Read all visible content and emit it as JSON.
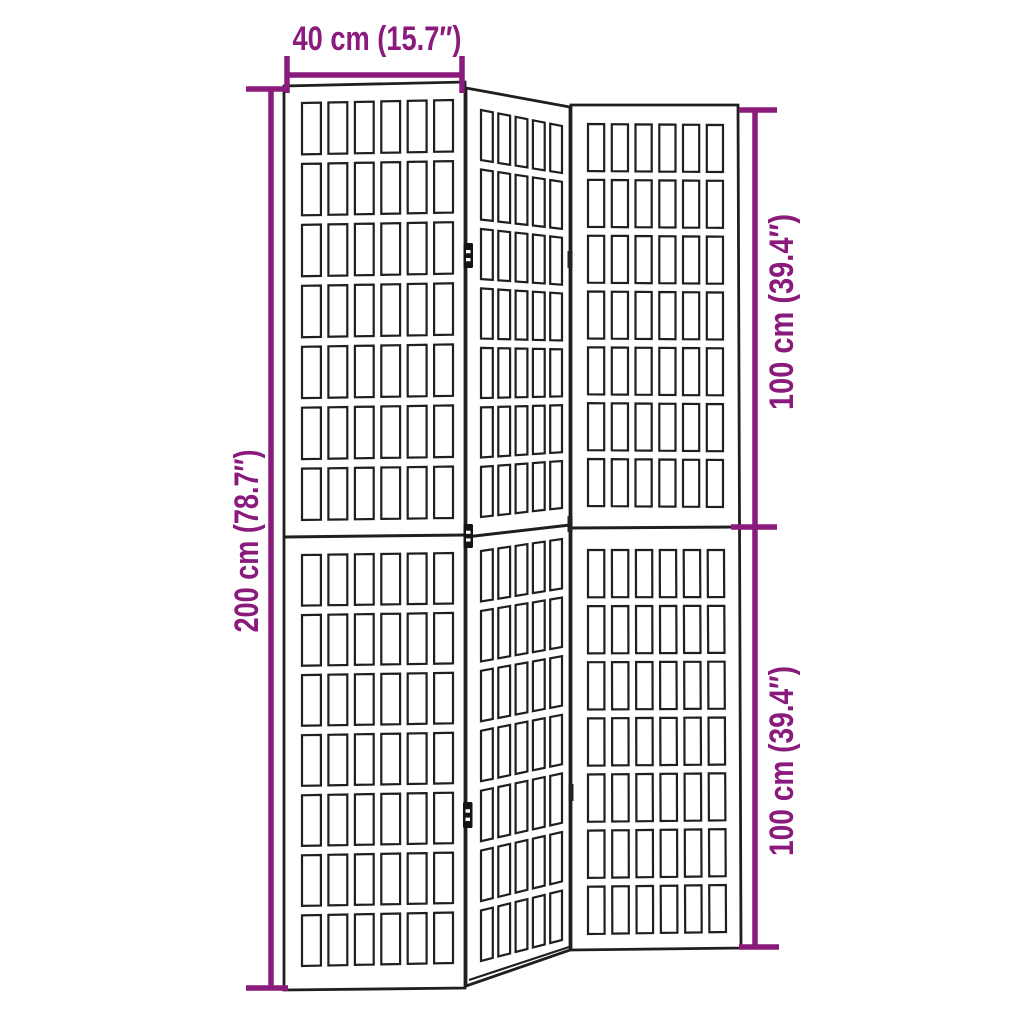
{
  "colors": {
    "dimension_annotation": "#8a1a7b",
    "figure_line": "#1f1f1f",
    "background": "#ffffff"
  },
  "dimensions": {
    "width": "40 cm (15.7″)",
    "height_total": "200 cm (78.7″)",
    "height_upper": "100 cm (39.4″)",
    "height_lower": "100 cm (39.4″)"
  },
  "figure": {
    "type": "folding-room-divider",
    "panel_count": 3,
    "line_color": "#1f1f1f",
    "panels": [
      {
        "id": "middle",
        "outer": [
          [
            466,
            88
          ],
          [
            570,
            107
          ],
          [
            570,
            950
          ],
          [
            466,
            986
          ]
        ],
        "midline": [
          466,
          537,
          570,
          525
        ],
        "halves": [
          {
            "lattice": [
              [
                481,
                110
              ],
              [
                562,
                126
              ],
              [
                562,
                508
              ],
              [
                481,
                517
              ]
            ],
            "cols": 5,
            "rows": 7,
            "gu": 0.068,
            "gv": 0.023
          },
          {
            "lattice": [
              [
                481,
                551
              ],
              [
                562,
                539
              ],
              [
                562,
                940
              ],
              [
                481,
                961
              ]
            ],
            "cols": 5,
            "rows": 7,
            "gu": 0.068,
            "gv": 0.023
          }
        ]
      },
      {
        "id": "left",
        "outer": [
          [
            284,
            86
          ],
          [
            465,
            82
          ],
          [
            465,
            988
          ],
          [
            284,
            990
          ]
        ],
        "midline": [
          284,
          537,
          465,
          535
        ],
        "halves": [
          {
            "lattice": [
              [
                302,
                103
              ],
              [
                453,
                100
              ],
              [
                453,
                518
              ],
              [
                302,
                520
              ]
            ],
            "cols": 6,
            "rows": 7,
            "gu": 0.05,
            "gv": 0.023
          },
          {
            "lattice": [
              [
                302,
                555
              ],
              [
                453,
                553
              ],
              [
                453,
                963
              ],
              [
                302,
                966
              ]
            ],
            "cols": 6,
            "rows": 7,
            "gu": 0.05,
            "gv": 0.023
          }
        ]
      },
      {
        "id": "right",
        "outer": [
          [
            571,
            105
          ],
          [
            738,
            105
          ],
          [
            741,
            948
          ],
          [
            571,
            950
          ]
        ],
        "midline": [
          571,
          528,
          739,
          527
        ],
        "halves": [
          {
            "lattice": [
              [
                588,
                124
              ],
              [
                723,
                125
              ],
              [
                723,
                507
              ],
              [
                588,
                506
              ]
            ],
            "cols": 6,
            "rows": 7,
            "gu": 0.056,
            "gv": 0.023
          },
          {
            "lattice": [
              [
                588,
                550
              ],
              [
                724,
                550
              ],
              [
                726,
                932
              ],
              [
                588,
                934
              ]
            ],
            "cols": 6,
            "rows": 7,
            "gu": 0.056,
            "gv": 0.023
          }
        ]
      }
    ],
    "hinges": [
      {
        "x": 463.5,
        "y": 243,
        "w": 9.5,
        "h": 25
      },
      {
        "x": 463.5,
        "y": 524,
        "w": 9.5,
        "h": 24
      },
      {
        "x": 463,
        "y": 802,
        "w": 9.5,
        "h": 26
      }
    ],
    "edge_marks": [
      {
        "x": 567.5,
        "y": 251,
        "w": 5,
        "h": 17
      },
      {
        "x": 567.5,
        "y": 516,
        "w": 5,
        "h": 16
      },
      {
        "x": 568.5,
        "y": 784,
        "w": 5,
        "h": 17
      }
    ],
    "extra_lines": [
      [
        469,
        980,
        569,
        947
      ]
    ]
  }
}
